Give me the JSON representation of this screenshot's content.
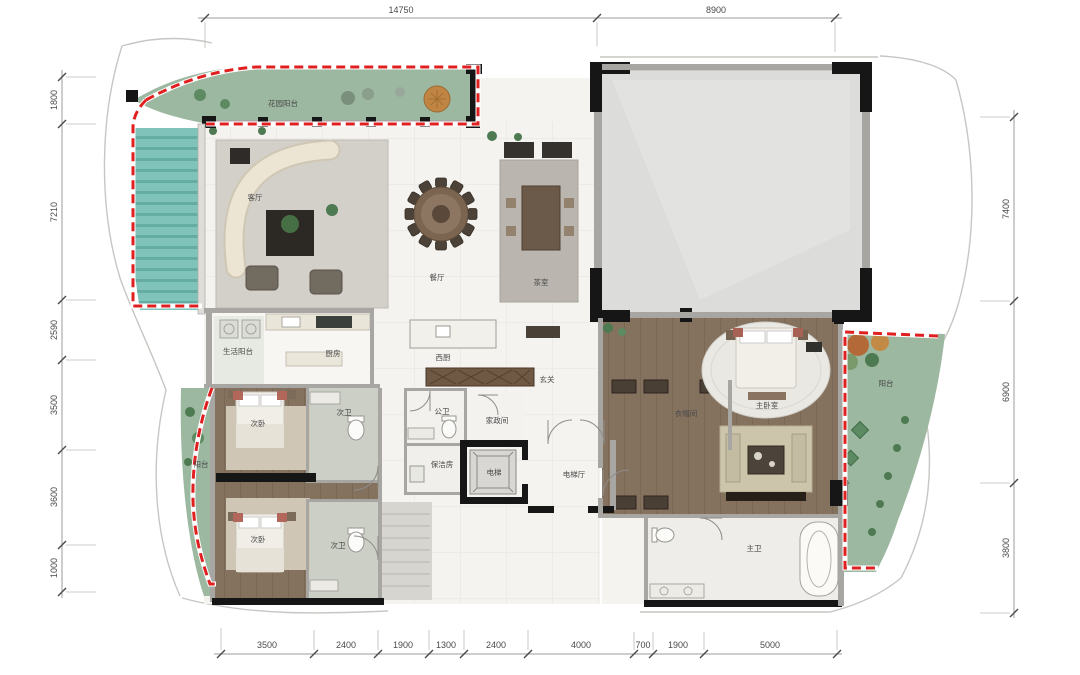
{
  "plan": {
    "title": "residential-floor-plan",
    "rooms": {
      "garden_balcony": "花园阳台",
      "living_room": "客厅",
      "dining_room": "餐厅",
      "tea_room": "茶室",
      "service_balcony": "生活阳台",
      "kitchen": "厨房",
      "west_kitchen": "西厨",
      "foyer": "玄关",
      "guest_bath": "公卫",
      "housekeeping_room": "家政间",
      "cleaning_room": "保洁房",
      "elevator": "电梯",
      "elevator_hall": "电梯厅",
      "cloakroom": "衣帽间",
      "master_bedroom": "主卧室",
      "master_bath": "主卫",
      "balcony_left": "阳台",
      "balcony_right": "阳台",
      "secondary_bedroom_1": "次卧",
      "secondary_bath_1": "次卫",
      "secondary_bedroom_2": "次卧",
      "secondary_bath_2": "次卫"
    },
    "dimensions": {
      "top": [
        "14750",
        "8900"
      ],
      "bottom": [
        "3500",
        "2400",
        "1900",
        "1300",
        "2400",
        "4000",
        "700",
        "1900",
        "5000"
      ],
      "left": [
        "1800",
        "7210",
        "2590",
        "3500",
        "3600",
        "1000"
      ],
      "right": [
        "7400",
        "6900",
        "3800"
      ]
    },
    "colors": {
      "boundary_red": "#e02020",
      "garden_green": "#9cb8a0",
      "pool_teal": "#7fc3ba",
      "marble_floor": "#f4f3f0",
      "gray_room": "#dcdcda",
      "wood_floor": "#84715e",
      "bath_tile": "#cccfc6",
      "wall_black": "#161616",
      "wall_gray": "#a8a6a2",
      "shrub_green": "#4e7a52",
      "tree_orange": "#c08443",
      "dim_text": "#4a4a4a",
      "label_text": "#4a4a4a"
    }
  }
}
